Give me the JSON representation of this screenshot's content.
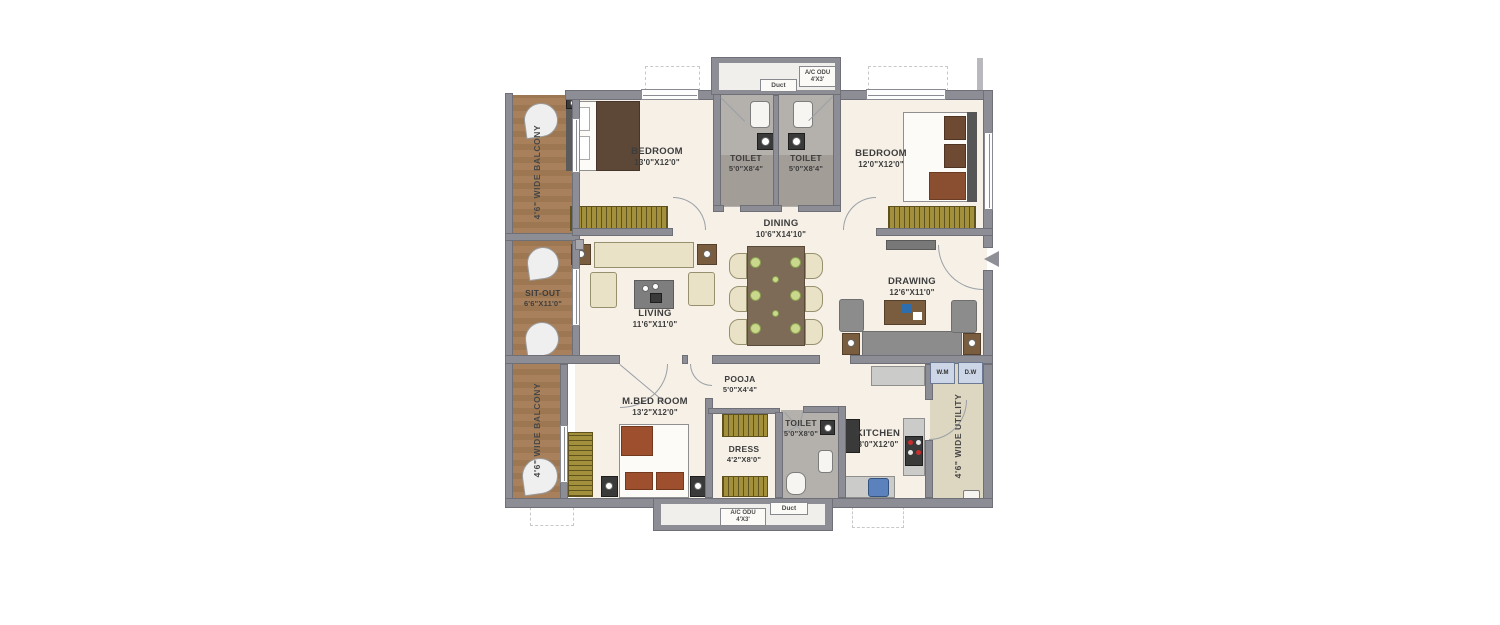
{
  "palette": {
    "wall": "#8d8d95",
    "wall_dark": "#6f6f77",
    "floor": "#f6f0e7",
    "toilet_floor": "#b4b0ab",
    "toilet_floor_dark": "#a39d97",
    "balcony": "#a8815c",
    "balcony_dark": "#9d7752",
    "utility": "#ddd6c0",
    "wardrobe": "#a2903c",
    "wardrobe_dark": "#5f521c",
    "wood": "#7a5c3e",
    "cream": "#e9e2c6",
    "gray_sofa": "#8c8c8c",
    "bed_dark": "#5d4737",
    "bed_red": "#9e4f2e",
    "bed_brown": "#8a4f30",
    "sink_blue": "#5b82bd",
    "plate": "#c9d88c",
    "line": "#9aa0a6"
  },
  "rooms": {
    "balcony_top": {
      "name": "4'6\" WIDE BALCONY"
    },
    "bedroom1": {
      "name": "BEDROOM",
      "dims": "13'0\"X12'0\""
    },
    "toilet1": {
      "name": "TOILET",
      "dims": "5'0\"X8'4\""
    },
    "toilet2": {
      "name": "TOILET",
      "dims": "5'0\"X8'4\""
    },
    "bedroom2": {
      "name": "BEDROOM",
      "dims": "12'0\"X12'0\""
    },
    "dining": {
      "name": "DINING",
      "dims": "10'6\"X14'10\""
    },
    "sitout": {
      "name": "SIT-OUT",
      "dims": "6'6\"X11'0\""
    },
    "living": {
      "name": "LIVING",
      "dims": "11'6\"X11'0\""
    },
    "drawing": {
      "name": "DRAWING",
      "dims": "12'6\"X11'0\""
    },
    "balcony_bottom": {
      "name": "4'6\" WIDE BALCONY"
    },
    "mbedroom": {
      "name": "M.BED ROOM",
      "dims": "13'2\"X12'0\""
    },
    "pooja": {
      "name": "POOJA",
      "dims": "5'0\"X4'4\""
    },
    "dress": {
      "name": "DRESS",
      "dims": "4'2\"X8'0\""
    },
    "toilet3": {
      "name": "TOILET",
      "dims": "5'0\"X8'0\""
    },
    "kitchen": {
      "name": "KITCHEN",
      "dims": "8'0\"X12'0\""
    },
    "utility": {
      "name": "4'6\" WIDE UTILITY"
    }
  },
  "service": {
    "duct_top": "Duct",
    "duct_bottom": "Duct",
    "ac_odu": "A/C ODU",
    "ac_odu_size": "4'X3'",
    "wm": "W.M",
    "dw": "D.W"
  }
}
